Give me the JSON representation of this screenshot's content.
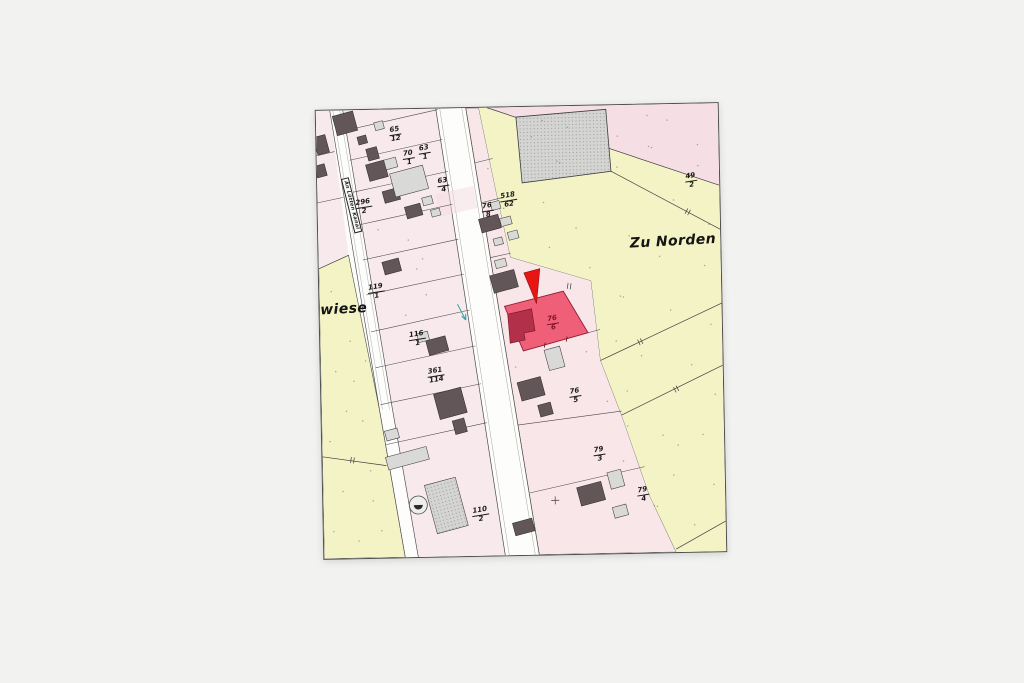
{
  "page": {
    "background_color": "#f2f2f1"
  },
  "map_sheet": {
    "street_label": "An Lütten Kanal",
    "area_labels": {
      "north": "Zu Norden v",
      "meadow": "nwiese"
    },
    "parcels": [
      {
        "id": "65-12",
        "num": "65",
        "den": "12"
      },
      {
        "id": "70-1",
        "num": "70",
        "den": "1"
      },
      {
        "id": "63-1",
        "num": "63",
        "den": "1"
      },
      {
        "id": "63-4",
        "num": "63",
        "den": "4"
      },
      {
        "id": "296-2",
        "num": "296",
        "den": "2"
      },
      {
        "id": "518-62",
        "num": "518",
        "den": "62"
      },
      {
        "id": "49-2",
        "num": "49",
        "den": "2"
      },
      {
        "id": "76-8",
        "num": "76",
        "den": "8"
      },
      {
        "id": "119-1",
        "num": "119",
        "den": "1"
      },
      {
        "id": "116-1",
        "num": "116",
        "den": "1"
      },
      {
        "id": "361-114",
        "num": "361",
        "den": "114"
      },
      {
        "id": "76-6",
        "num": "76",
        "den": "6",
        "highlighted": true
      },
      {
        "id": "76-5",
        "num": "76",
        "den": "5"
      },
      {
        "id": "79-3",
        "num": "79",
        "den": "3"
      },
      {
        "id": "79-4",
        "num": "79",
        "den": "4"
      },
      {
        "id": "110-2",
        "num": "110",
        "den": "2"
      }
    ],
    "highlight": {
      "parcel": "76/6",
      "fill": "#ef6078",
      "building_fill": "#b23049",
      "marker_color": "#e81515"
    },
    "colors": {
      "yellow_field": "#f3f3c6",
      "pink_parcel": "#f8e9ec",
      "pink_parcel_right": "#f8e6e9",
      "pink_corner": "#f6dee5",
      "street": "#fdfdfb",
      "building_dark": "#635659",
      "building_light": "#d9d9d7",
      "boundary_line": "#4a4a4a"
    }
  }
}
